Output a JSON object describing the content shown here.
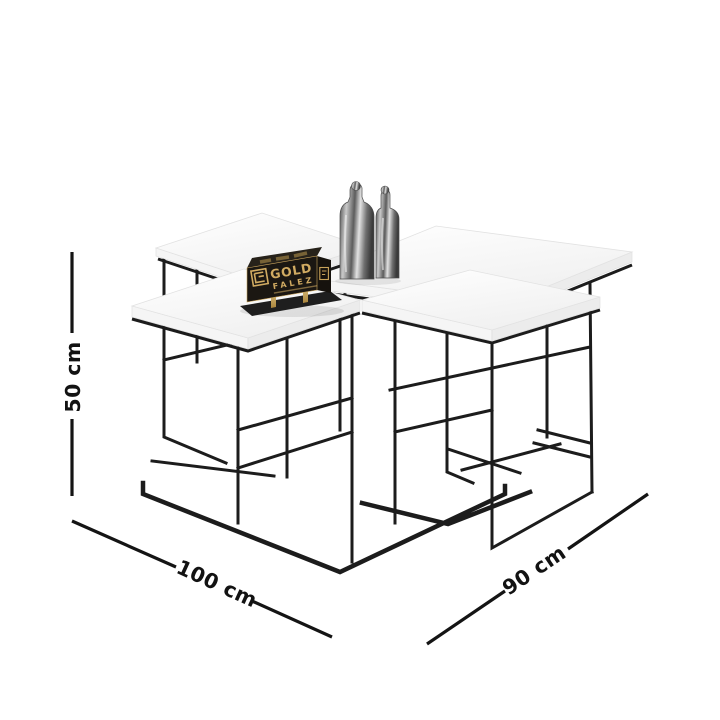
{
  "page": {
    "background_color": "#ffffff"
  },
  "illustration": {
    "description": "White nesting coffee table set with black metal wire frame, two marble decor bottles and a gold brand plaque",
    "tabletop_color": "#fafafa",
    "frame_color": "#1c1c1c"
  },
  "brand_plaque": {
    "word1": "GOLD",
    "word2": "FALEZ",
    "gold_color": "#d1ab62",
    "body_color": "#1b1712"
  },
  "dimensions": {
    "height": "50 cm",
    "width": "100 cm",
    "depth": "90 cm"
  }
}
